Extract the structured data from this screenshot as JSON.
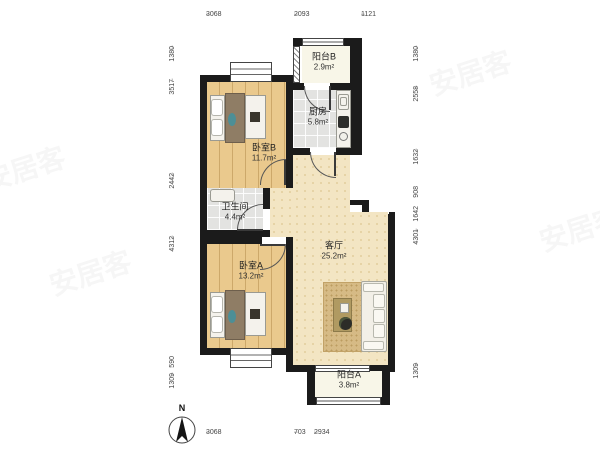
{
  "plan": {
    "rooms": [
      {
        "id": "balcony-b",
        "name": "阳台B",
        "area": "2.9m²"
      },
      {
        "id": "kitchen",
        "name": "厨房",
        "area": "5.8m²"
      },
      {
        "id": "bedroom-b",
        "name": "卧室B",
        "area": "11.7m²"
      },
      {
        "id": "bathroom",
        "name": "卫生间",
        "area": "4.4m²"
      },
      {
        "id": "living-room",
        "name": "客厅",
        "area": "25.2m²"
      },
      {
        "id": "bedroom-a",
        "name": "卧室A",
        "area": "13.2m²"
      },
      {
        "id": "balcony-a",
        "name": "阳台A",
        "area": "3.8m²"
      }
    ],
    "dimensions": {
      "top": [
        "3068",
        "2093",
        "1121"
      ],
      "bottom": [
        "3068",
        "703",
        "2934"
      ],
      "left": [
        "1380",
        "3517",
        "2442",
        "4312",
        "590",
        "1309"
      ],
      "right": [
        "1380",
        "2558",
        "1632",
        "908",
        "1642",
        "4301",
        "1309"
      ]
    },
    "compass": {
      "label": "N"
    },
    "watermark": {
      "text": "安居客"
    },
    "colors": {
      "wall": "#1b1b1b",
      "wood": "#eac98d",
      "tile": "#e3e3e1",
      "living": "#f3e5c3",
      "balcony": "#f8f6e8",
      "accent": "#4d8f96"
    }
  }
}
